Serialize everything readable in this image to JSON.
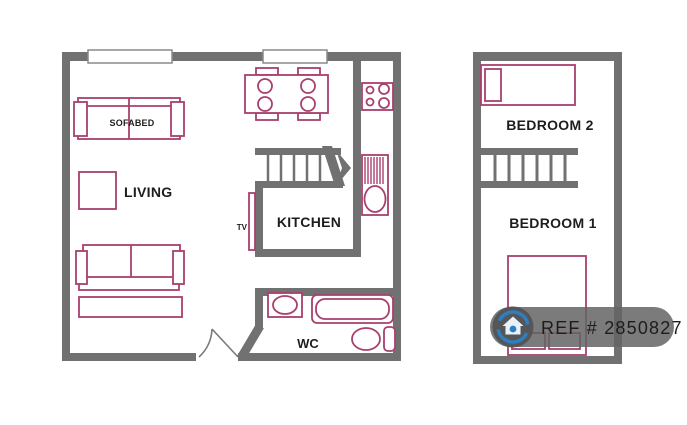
{
  "plans": {
    "ground_floor": {
      "rooms": {
        "living": {
          "label": "LIVING"
        },
        "kitchen": {
          "label": "KITCHEN"
        },
        "wc": {
          "label": "WC"
        }
      },
      "furniture": {
        "sofabed": {
          "label": "SOFABED"
        },
        "tv": {
          "label": "TV"
        }
      }
    },
    "first_floor": {
      "rooms": {
        "bedroom2": {
          "label": "BEDROOM 2"
        },
        "bedroom1": {
          "label": "BEDROOM 1"
        }
      }
    }
  },
  "watermark": {
    "ref_label": "REF # 2850827",
    "icon": "circular-arrows-house-icon"
  },
  "colors": {
    "background": "#ffffff",
    "wall": "#717171",
    "furniture_outline": "#a8406e",
    "label_text": "#1d1d1b",
    "watermark_bg": "rgba(100,100,100,0.85)",
    "watermark_text": "#d9d9d9",
    "watermark_icon_blue": "#2e7fc0",
    "watermark_icon_disc": "#55565a",
    "watermark_house": "#e8f1f8"
  }
}
